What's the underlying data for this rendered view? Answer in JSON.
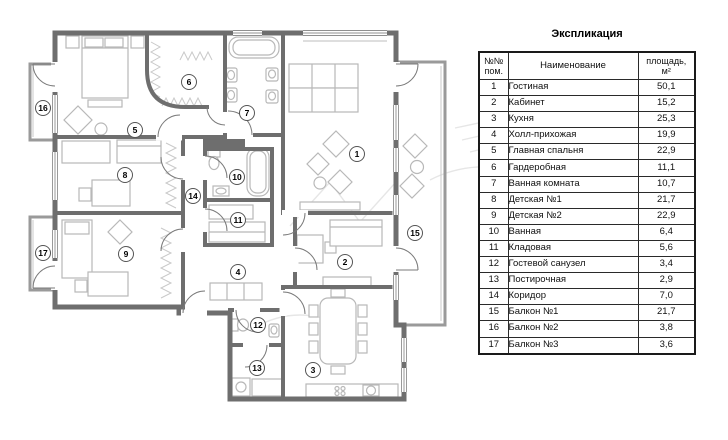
{
  "title": "Экспликация",
  "table": {
    "header": {
      "num_line1": "№№",
      "num_line2": "пом.",
      "name": "Наименование",
      "area_line1": "площадь,",
      "area_line2": "м²"
    },
    "rows": [
      {
        "num": "1",
        "name": "Гостиная",
        "area": "50,1"
      },
      {
        "num": "2",
        "name": "Кабинет",
        "area": "15,2"
      },
      {
        "num": "3",
        "name": "Кухня",
        "area": "25,3"
      },
      {
        "num": "4",
        "name": "Холл-прихожая",
        "area": "19,9"
      },
      {
        "num": "5",
        "name": "Главная спальня",
        "area": "22,9"
      },
      {
        "num": "6",
        "name": "Гардеробная",
        "area": "11,1"
      },
      {
        "num": "7",
        "name": "Ванная комната",
        "area": "10,7"
      },
      {
        "num": "8",
        "name": "Детская №1",
        "area": "21,7"
      },
      {
        "num": "9",
        "name": "Детская №2",
        "area": "22,9"
      },
      {
        "num": "10",
        "name": "Ванная",
        "area": "6,4"
      },
      {
        "num": "11",
        "name": "Кладовая",
        "area": "5,6"
      },
      {
        "num": "12",
        "name": "Гостевой санузел",
        "area": "3,4"
      },
      {
        "num": "13",
        "name": "Постирочная",
        "area": "2,9"
      },
      {
        "num": "14",
        "name": "Коридор",
        "area": "7,0"
      },
      {
        "num": "15",
        "name": "Балкон №1",
        "area": "21,7"
      },
      {
        "num": "16",
        "name": "Балкон №2",
        "area": "3,8"
      },
      {
        "num": "17",
        "name": "Балкон №3",
        "area": "3,6"
      }
    ]
  },
  "plan": {
    "room_markers": [
      "1",
      "2",
      "3",
      "4",
      "5",
      "6",
      "7",
      "8",
      "9",
      "10",
      "11",
      "12",
      "13",
      "14",
      "15",
      "16",
      "17"
    ],
    "colors": {
      "wall": "#6e6e6e",
      "furniture": "#b8b8b8",
      "balcony_wall": "#9a9a9a"
    }
  }
}
